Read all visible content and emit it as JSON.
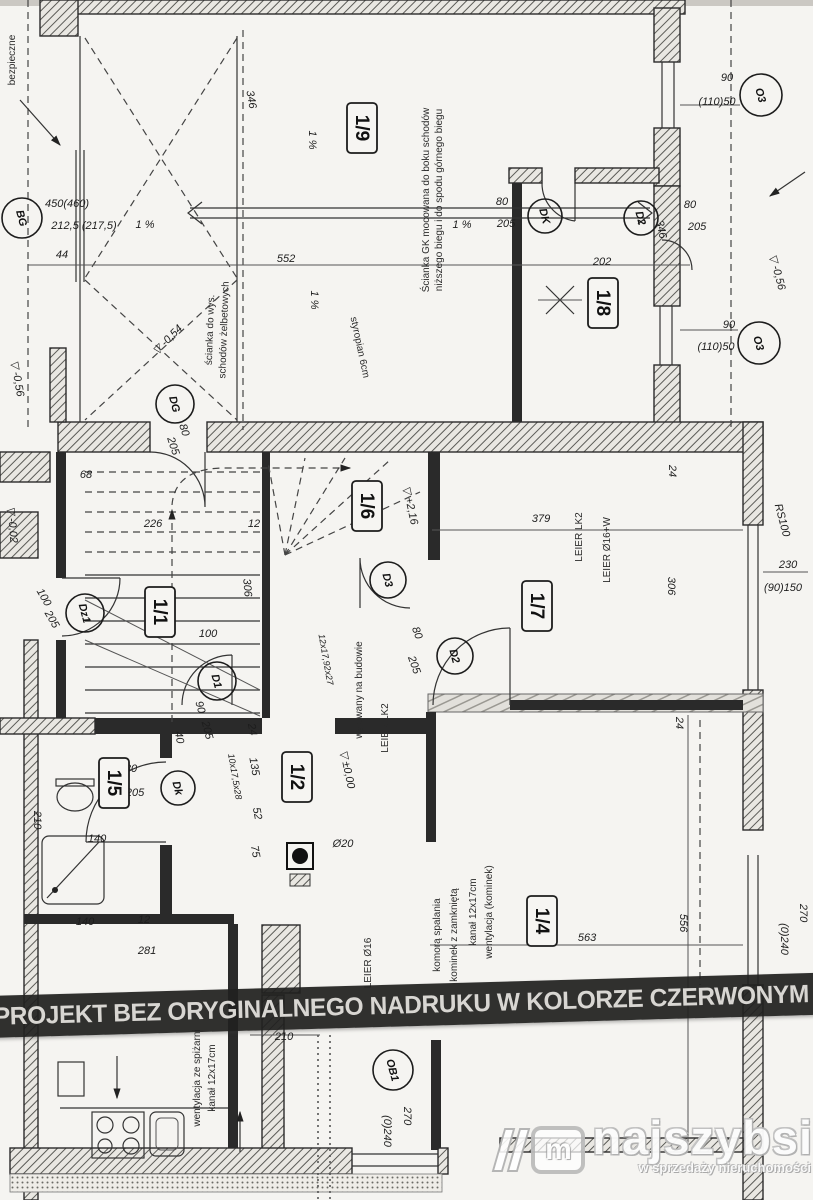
{
  "banner": {
    "text": "PROJEKT BEZ ORYGINALNEGO NADRUKU W KOLORZE CZERWONYM JEST"
  },
  "logo": {
    "brand": "najszybsi",
    "tagline": "w sprzedaży nieruchomości",
    "monogram": "m"
  },
  "plan": {
    "room_labels": [
      {
        "t": "1/9",
        "x": 362,
        "y": 128
      },
      {
        "t": "1/8",
        "x": 603,
        "y": 303
      },
      {
        "t": "1/6",
        "x": 367,
        "y": 506
      },
      {
        "t": "1/7",
        "x": 537,
        "y": 606
      },
      {
        "t": "1/1",
        "x": 160,
        "y": 612
      },
      {
        "t": "1/5",
        "x": 114,
        "y": 783
      },
      {
        "t": "1/2",
        "x": 297,
        "y": 777
      },
      {
        "t": "1/4",
        "x": 542,
        "y": 921
      }
    ],
    "door_tags": [
      {
        "t": "BG",
        "x": 22,
        "y": 218,
        "rad": 20
      },
      {
        "t": "DK",
        "x": 545,
        "y": 216,
        "rad": 17
      },
      {
        "t": "D2",
        "x": 641,
        "y": 218,
        "rad": 17
      },
      {
        "t": "O3",
        "x": 761,
        "y": 95,
        "rad": 21
      },
      {
        "t": "O3",
        "x": 759,
        "y": 343,
        "rad": 21
      },
      {
        "t": "DG",
        "x": 175,
        "y": 404,
        "rad": 19
      },
      {
        "t": "Dz1",
        "x": 85,
        "y": 613,
        "rad": 19
      },
      {
        "t": "D1",
        "x": 217,
        "y": 681,
        "rad": 19
      },
      {
        "t": "D3",
        "x": 388,
        "y": 580,
        "rad": 18
      },
      {
        "t": "D2",
        "x": 455,
        "y": 656,
        "rad": 18
      },
      {
        "t": "Dk",
        "x": 178,
        "y": 788,
        "rad": 17
      },
      {
        "t": "OB1",
        "x": 393,
        "y": 1070,
        "rad": 20
      }
    ],
    "texts": [
      {
        "t": "450(460)",
        "x": 67,
        "y": 207,
        "k": "dim"
      },
      {
        "t": "212,5 (217,5)",
        "x": 84,
        "y": 229,
        "k": "dim"
      },
      {
        "t": "1 %",
        "x": 145,
        "y": 228,
        "k": "dim"
      },
      {
        "t": "44",
        "x": 62,
        "y": 258,
        "k": "dim"
      },
      {
        "t": "552",
        "x": 286,
        "y": 262,
        "k": "dim"
      },
      {
        "t": "346",
        "x": 248,
        "y": 100,
        "r": 80,
        "k": "dim"
      },
      {
        "t": "1 %",
        "x": 309,
        "y": 140,
        "r": 90,
        "k": "dim"
      },
      {
        "t": "1 %",
        "x": 311,
        "y": 300,
        "r": 90,
        "k": "dim"
      },
      {
        "t": "80",
        "x": 502,
        "y": 205,
        "k": "dim"
      },
      {
        "t": "205",
        "x": 506,
        "y": 227,
        "k": "dim"
      },
      {
        "t": "1 %",
        "x": 462,
        "y": 228,
        "k": "dim"
      },
      {
        "t": "80",
        "x": 690,
        "y": 208,
        "k": "dim"
      },
      {
        "t": "205",
        "x": 697,
        "y": 230,
        "k": "dim"
      },
      {
        "t": "202",
        "x": 602,
        "y": 265,
        "k": "dim"
      },
      {
        "t": "90",
        "x": 727,
        "y": 81,
        "k": "dim"
      },
      {
        "t": "(110)50",
        "x": 717,
        "y": 105,
        "k": "dim"
      },
      {
        "t": "90",
        "x": 729,
        "y": 328,
        "k": "dim"
      },
      {
        "t": "(110)50",
        "x": 716,
        "y": 350,
        "k": "dim"
      },
      {
        "t": "346",
        "x": 658,
        "y": 230,
        "r": 78,
        "k": "dim"
      },
      {
        "t": "68",
        "x": 86,
        "y": 478,
        "k": "dim"
      },
      {
        "t": "226",
        "x": 153,
        "y": 527,
        "k": "dim"
      },
      {
        "t": "12",
        "x": 254,
        "y": 527,
        "k": "dim"
      },
      {
        "t": "80",
        "x": 181,
        "y": 431,
        "r": 72,
        "k": "dim"
      },
      {
        "t": "205",
        "x": 170,
        "y": 447,
        "r": 72,
        "k": "dim"
      },
      {
        "t": "100",
        "x": 41,
        "y": 599,
        "r": 60,
        "k": "dim"
      },
      {
        "t": "205",
        "x": 49,
        "y": 621,
        "r": 60,
        "k": "dim"
      },
      {
        "t": "306",
        "x": 244,
        "y": 588,
        "r": 85,
        "k": "dim"
      },
      {
        "t": "100",
        "x": 208,
        "y": 637,
        "k": "dim"
      },
      {
        "t": "379",
        "x": 541,
        "y": 522,
        "k": "dim"
      },
      {
        "t": "24",
        "x": 669,
        "y": 471,
        "r": 90,
        "k": "dim"
      },
      {
        "t": "306",
        "x": 668,
        "y": 586,
        "r": 90,
        "k": "dim"
      },
      {
        "t": "230",
        "x": 788,
        "y": 568,
        "k": "dim"
      },
      {
        "t": "(90)150",
        "x": 783,
        "y": 591,
        "k": "dim"
      },
      {
        "t": "RS100",
        "x": 779,
        "y": 521,
        "r": 75,
        "k": "dim"
      },
      {
        "t": "24",
        "x": 676,
        "y": 723,
        "r": 90,
        "k": "dim"
      },
      {
        "t": "556",
        "x": 680,
        "y": 923,
        "r": 90,
        "k": "dim"
      },
      {
        "t": "563",
        "x": 587,
        "y": 941,
        "k": "dim"
      },
      {
        "t": "270",
        "x": 800,
        "y": 913,
        "r": 90,
        "k": "dim"
      },
      {
        "t": "(0)240",
        "x": 781,
        "y": 939,
        "r": 90,
        "k": "dim"
      },
      {
        "t": "90",
        "x": 197,
        "y": 708,
        "r": 75,
        "k": "dim"
      },
      {
        "t": "205",
        "x": 204,
        "y": 731,
        "r": 75,
        "k": "dim"
      },
      {
        "t": "40",
        "x": 176,
        "y": 738,
        "r": 80,
        "k": "dim"
      },
      {
        "t": "24",
        "x": 249,
        "y": 730,
        "r": 80,
        "k": "dim"
      },
      {
        "t": "135",
        "x": 251,
        "y": 767,
        "r": 80,
        "k": "dim"
      },
      {
        "t": "52",
        "x": 254,
        "y": 814,
        "r": 80,
        "k": "dim"
      },
      {
        "t": "10x17,5x28",
        "x": 232,
        "y": 777,
        "r": 80,
        "s": 9,
        "k": "dim"
      },
      {
        "t": "12x17,92x27",
        "x": 323,
        "y": 660,
        "r": 80,
        "s": 9,
        "k": "dim"
      },
      {
        "t": "75",
        "x": 252,
        "y": 852,
        "r": 80,
        "k": "dim"
      },
      {
        "t": "Ø20",
        "x": 343,
        "y": 847,
        "k": "dim"
      },
      {
        "t": "140",
        "x": 97,
        "y": 842,
        "k": "dim"
      },
      {
        "t": "210",
        "x": 34,
        "y": 820,
        "r": 90,
        "k": "dim"
      },
      {
        "t": "140",
        "x": 85,
        "y": 925,
        "k": "dim"
      },
      {
        "t": "12",
        "x": 144,
        "y": 923,
        "k": "dim"
      },
      {
        "t": "281",
        "x": 147,
        "y": 954,
        "k": "dim"
      },
      {
        "t": "210",
        "x": 284,
        "y": 1040,
        "k": "dim"
      },
      {
        "t": "80",
        "x": 131,
        "y": 772,
        "k": "dim"
      },
      {
        "t": "205",
        "x": 135,
        "y": 796,
        "k": "dim"
      },
      {
        "t": "80",
        "x": 414,
        "y": 634,
        "r": 70,
        "k": "dim"
      },
      {
        "t": "205",
        "x": 411,
        "y": 666,
        "r": 70,
        "k": "dim"
      },
      {
        "t": "270",
        "x": 404,
        "y": 1116,
        "r": 90,
        "k": "dim"
      },
      {
        "t": "(0)240",
        "x": 384,
        "y": 1131,
        "r": 90,
        "k": "dim"
      },
      {
        "t": "-0,56",
        "x": 14,
        "y": 379,
        "r": 80,
        "k": "level"
      },
      {
        "t": "-0,54",
        "x": 170,
        "y": 342,
        "r": -45,
        "k": "level"
      },
      {
        "t": "-0,02",
        "x": 9,
        "y": 525,
        "r": 85,
        "k": "level"
      },
      {
        "t": "+2,16",
        "x": 407,
        "y": 506,
        "r": 78,
        "k": "level"
      },
      {
        "t": "±0,00",
        "x": 344,
        "y": 770,
        "r": 78,
        "k": "level"
      },
      {
        "t": "-0,56",
        "x": 774,
        "y": 273,
        "r": 75,
        "k": "level"
      },
      {
        "t": "Ścianka GK mocowana do boku schodów",
        "x": 429,
        "y": 200,
        "r": -90,
        "s": 10,
        "k": "note"
      },
      {
        "t": "niższego biegu i do spodu górnego biegu",
        "x": 442,
        "y": 200,
        "r": -90,
        "s": 10,
        "k": "note"
      },
      {
        "t": "styropian 6cm",
        "x": 357,
        "y": 348,
        "r": 78,
        "s": 10,
        "k": "note"
      },
      {
        "t": "ścianka do wys.",
        "x": 213,
        "y": 330,
        "r": -88,
        "s": 10,
        "k": "note"
      },
      {
        "t": "schodów żelbetowych",
        "x": 227,
        "y": 330,
        "r": -88,
        "s": 10,
        "k": "note"
      },
      {
        "t": "bezpieczne",
        "x": 15,
        "y": 60,
        "r": -90,
        "s": 10,
        "k": "note"
      },
      {
        "t": "LEIER LK2",
        "x": 582,
        "y": 537,
        "r": -90,
        "s": 10,
        "k": "note"
      },
      {
        "t": "LEIER Ø16+W",
        "x": 610,
        "y": 550,
        "r": -90,
        "s": 10,
        "k": "note"
      },
      {
        "t": "LEIER LK2",
        "x": 388,
        "y": 728,
        "r": -90,
        "s": 10,
        "k": "note"
      },
      {
        "t": "LEIER Ø16",
        "x": 371,
        "y": 963,
        "r": -90,
        "s": 10,
        "k": "note"
      },
      {
        "t": "wylewany na budowie",
        "x": 362,
        "y": 690,
        "r": -90,
        "s": 10,
        "k": "note"
      },
      {
        "t": "wentylacja (kominek)",
        "x": 492,
        "y": 912,
        "r": -90,
        "s": 10,
        "k": "note"
      },
      {
        "t": "kanał 12x17cm",
        "x": 476,
        "y": 912,
        "r": -90,
        "s": 10,
        "k": "note"
      },
      {
        "t": "kominek z zamkniętą",
        "x": 457,
        "y": 935,
        "r": -90,
        "s": 10,
        "k": "note"
      },
      {
        "t": "komorą spalania",
        "x": 440,
        "y": 935,
        "r": -90,
        "s": 10,
        "k": "note"
      },
      {
        "t": "wentylacja ze spiżarni",
        "x": 200,
        "y": 1078,
        "r": -90,
        "s": 10,
        "k": "note"
      },
      {
        "t": "kanał 12x17cm",
        "x": 215,
        "y": 1078,
        "r": -90,
        "s": 10,
        "k": "note"
      }
    ]
  }
}
